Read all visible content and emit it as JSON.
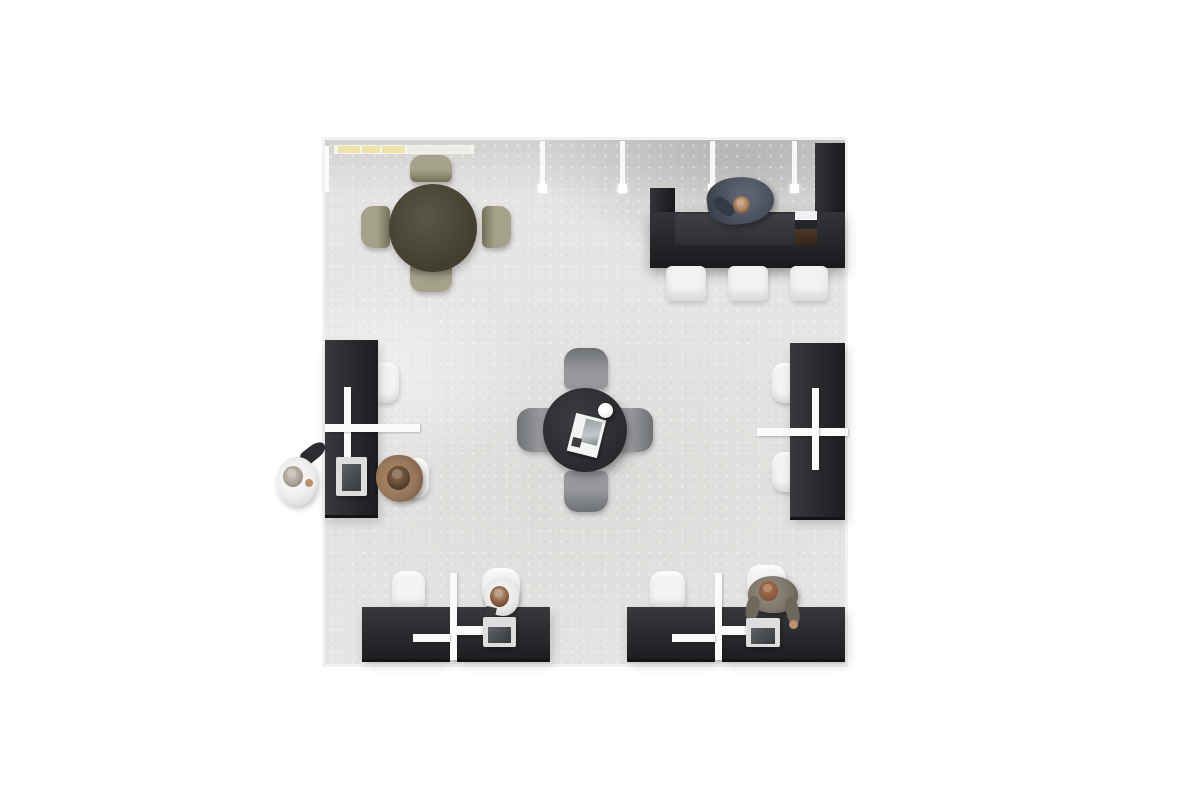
{
  "scene": {
    "view": "top-down 3d render of an office interior on a white background",
    "objects": [
      {
        "name": "cafe-table-area",
        "label": "round dark-olive cafe table with four olive chairs"
      },
      {
        "name": "reception-area",
        "label": "black U-shaped reception counter with coffee machine, three white stools and a receptionist in a dark suit"
      },
      {
        "name": "center-table-area",
        "label": "round black table with four gray chairs, an open magazine and a white cup"
      },
      {
        "name": "left-workstation",
        "label": "black desk against left wall with white divider cross, laptop, seated worker in tan jacket and standing visitor in white holding a dark bag"
      },
      {
        "name": "right-workstation",
        "label": "black double desk against right wall with white divider and two white chairs"
      },
      {
        "name": "bottom-left-workstation",
        "label": "black double desk with white divider, white chairs and a seated worker at a laptop"
      },
      {
        "name": "bottom-right-workstation",
        "label": "black double desk with white divider, white chair and a standing worker leaning over a laptop"
      },
      {
        "name": "wall-lights",
        "label": "four white pendant strips and a yellow-lit shelf along the top wall"
      }
    ]
  },
  "colors": {
    "page_bg": "#ffffff",
    "floor": "#e6e5e3",
    "floor_border": "#f3f2f1",
    "desk": "#27282c",
    "desk_edge": "#131417",
    "counter": "#222328",
    "counter_inner": "#34353b",
    "partition": "#fbfbfa",
    "chair_white": "#f4f4f2",
    "stool_white": "#f2f2f0",
    "chair_gray": "#96989b",
    "chair_gray_dark": "#6e7174",
    "chair_olive": "#a5a28b",
    "chair_olive_dark": "#74715a",
    "table_olive": "#484330",
    "table_black": "#2c2d31",
    "laptop_silver": "#dcdddc",
    "laptop_screen": "#43474b",
    "machine_paper": "#eff0ef",
    "machine_band": "#24252b",
    "machine_body": "#4c3828",
    "light_yellow": "#ede4ac",
    "light_pale": "#edece6",
    "suit": "#49505c",
    "suit_dark": "#353b46",
    "skin": "#bb916f",
    "hair_brown": "#6b4c36",
    "hair_auburn": "#8a5a40",
    "hair_dark": "#473828",
    "hair_gray": "#a39b90",
    "jacket_tan": "#96755a",
    "outfit_white": "#ededeb",
    "shirt_white": "#e9e9e8",
    "top_khaki": "#7d766a",
    "bag_dark": "#2d2d31",
    "ball": "#f2f2ef",
    "magazine": "#f4f4f2",
    "magazine_photo": "#9aa0a4"
  }
}
